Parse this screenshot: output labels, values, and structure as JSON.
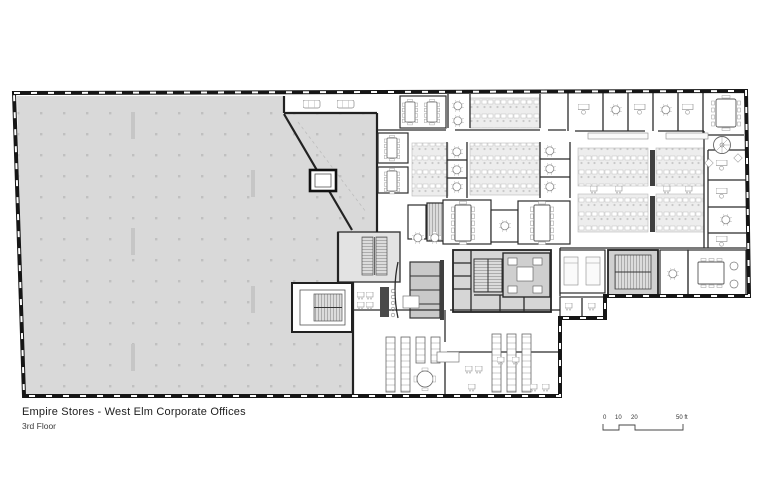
{
  "doc": {
    "title": "Empire Stores - West Elm Corporate Offices",
    "subtitle": "3rd Floor"
  },
  "scale_bar": {
    "labels": [
      "0",
      "10",
      "20",
      "50 ft"
    ]
  },
  "colors": {
    "warehouse_fill": "#d9d9d9",
    "core_fill": "#d6d6d6",
    "stair_fill": "#d0d0d0",
    "locker_fill": "#c9c9c9",
    "cluster_fill": "#ededed",
    "wall": "#161616"
  }
}
